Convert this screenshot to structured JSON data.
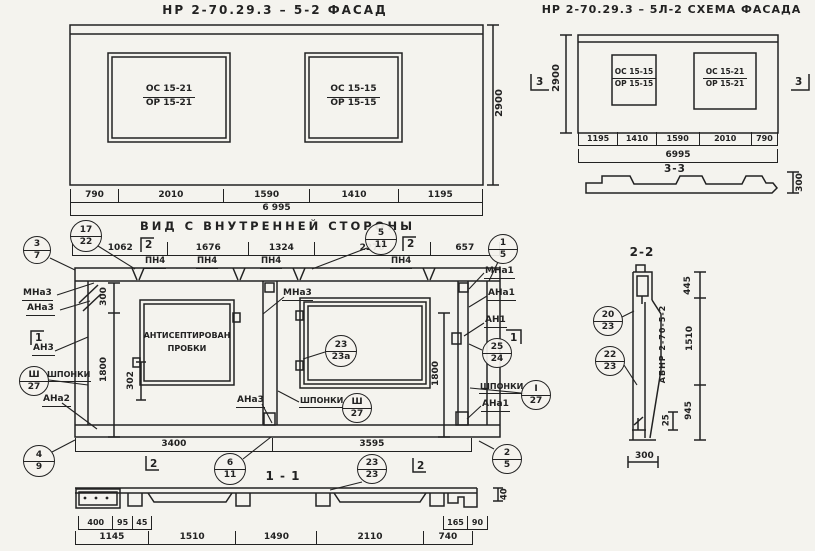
{
  "paper": "#f4f3ee",
  "ink": "#222222",
  "facade": {
    "title": "НР 2-70.29.3 – 5-2    ФАСАД",
    "window_left": {
      "top": "ОС 15-21",
      "bottom": "ОР 15-21"
    },
    "window_right": {
      "top": "ОС 15-15",
      "bottom": "ОР 15-15"
    },
    "dim_height": "2900",
    "dims": [
      "790",
      "2010",
      "1590",
      "1410",
      "1195"
    ],
    "dim_total": "6 995"
  },
  "schema": {
    "title": "НР 2-70.29.3 – 5Л-2  СХЕМА ФАСАДА",
    "window_left": {
      "top": "ОС 15-15",
      "bottom": "ОР 15-15"
    },
    "window_right": {
      "top": "ОС 15-21",
      "bottom": "ОР 15-21"
    },
    "dim_height": "2900",
    "dims": [
      "1195",
      "1410",
      "1590",
      "2010",
      "790"
    ],
    "dim_total": "6995",
    "flag_left": "3",
    "flag_right": "3",
    "section_label": "3-3",
    "section_dim": "300"
  },
  "inner": {
    "title": "ВИД С ВНУТРЕННЕЙ СТОРОНЫ",
    "dims_top": [
      "1062",
      "1676",
      "1324",
      "2276",
      "657"
    ],
    "pn": [
      "ПН4",
      "ПН4",
      "ПН4",
      "ПН4"
    ],
    "dims_bottom": [
      "3400",
      "3595"
    ],
    "dim_300": "300",
    "dim_1800_left": "1800",
    "dim_302": "302",
    "dim_1800_right": "1800",
    "flag_top_left": "2",
    "flag_top_right": "2",
    "flag_bottom_left": "2",
    "flag_bottom_right": "2",
    "flag_left": "1",
    "flag_right": "1",
    "labels": {
      "mna3_left": "МНа3",
      "ana3_left": "АНа3",
      "an3": "АН3",
      "shponki_left": "ШПОНКИ",
      "ana2": "АНа2",
      "mna3_center": "МНа3",
      "ana3_center": "АНа3",
      "shponki_center": "ШПОНКИ",
      "mna1": "МНа1",
      "ana1_top": "АНа1",
      "an1": "АН1",
      "shponki_right": "ШПОНКИ",
      "ana1_bottom": "АНа1",
      "plug_line1": "АНТИСЕПТИРОВАН",
      "plug_line2": "ПРОБКИ"
    },
    "markers": {
      "m3_7": {
        "top": "3",
        "bottom": "7"
      },
      "m17_22": {
        "top": "17",
        "bottom": "22"
      },
      "m5_11": {
        "top": "5",
        "bottom": "11"
      },
      "m1_5": {
        "top": "1",
        "bottom": "5"
      },
      "m4_9": {
        "top": "4",
        "bottom": "9"
      },
      "m6_11": {
        "top": "6",
        "bottom": "11"
      },
      "m23_23a": {
        "top": "23",
        "bottom": "23а"
      },
      "m23_23": {
        "top": "23",
        "bottom": "23"
      },
      "m2_5": {
        "top": "2",
        "bottom": "5"
      },
      "m25_24": {
        "top": "25",
        "bottom": "24"
      },
      "msh_left": {
        "top": "Ш",
        "bottom": "27"
      },
      "msh_center": {
        "top": "Ш",
        "bottom": "27"
      },
      "msh_right": {
        "top": "I",
        "bottom": "27"
      }
    }
  },
  "section11": {
    "label": "1 - 1",
    "dims_small_left": [
      "400",
      "95",
      "45"
    ],
    "dims_small_right": [
      "165",
      "90"
    ],
    "dim_40": "40",
    "dims": [
      "1145",
      "1510",
      "1490",
      "2110",
      "740"
    ]
  },
  "section22": {
    "label": "2-2",
    "mark": "АБНР 2-70-5-2",
    "dim_445": "445",
    "dim_1510": "1510",
    "dim_945": "945",
    "dim_25": "25",
    "dim_300": "300",
    "markers": {
      "m20_23": {
        "top": "20",
        "bottom": "23"
      },
      "m22_23": {
        "top": "22",
        "bottom": "23"
      }
    }
  }
}
